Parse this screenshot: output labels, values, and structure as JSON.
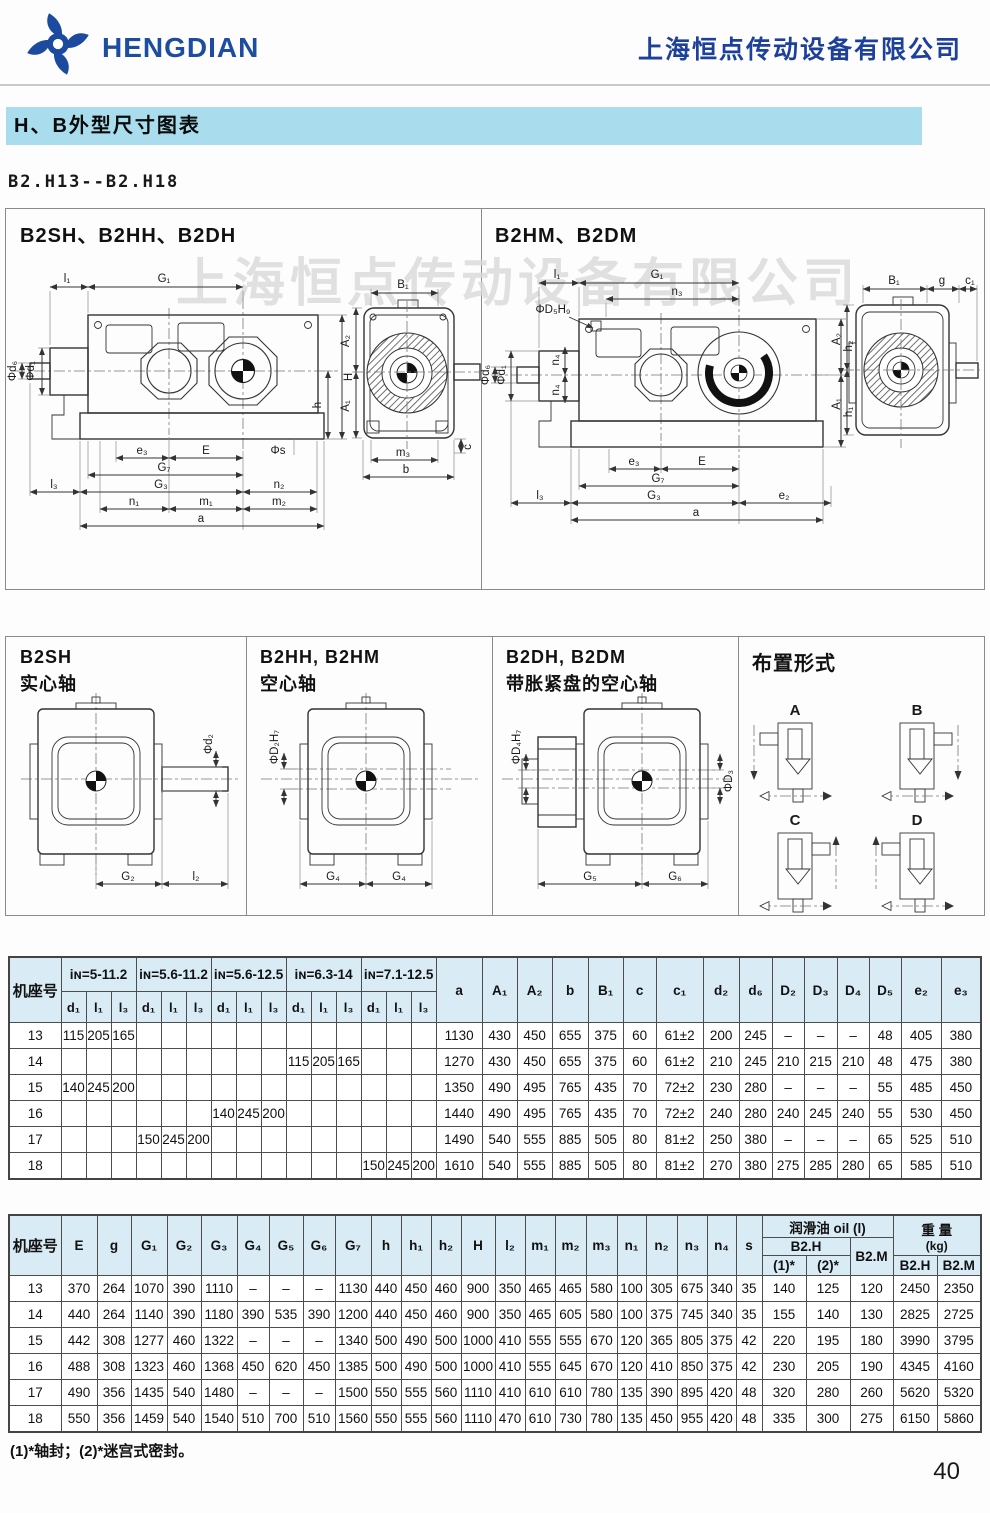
{
  "header": {
    "logo_text": "HENGDIAN",
    "company": "上海恒点传动设备有限公司"
  },
  "section": {
    "title": "H、B外型尺寸图表",
    "model_range": "B2.H13--B2.H18"
  },
  "watermark": "上海恒点传动设备有限公司",
  "colors": {
    "accent_blue": "#1d4da0",
    "banner_bg": "#a9ddee",
    "table_header_bg": "#d9ecf5"
  },
  "diagrams": {
    "panel1": {
      "title": "B2SH、B2HH、B2DH",
      "labels": {
        "l1": "l₁",
        "G1": "G₁",
        "d1": "Φd₁",
        "d6": "Φd₆",
        "H": "H",
        "h": "h",
        "c": "c",
        "e3": "e₃",
        "E": "E",
        "s": "Φs",
        "G7": "G₇",
        "G3": "G₃",
        "n2": "n₂",
        "l3": "l₃",
        "n1": "n₁",
        "m1": "m₁",
        "m2": "m₂",
        "a": "a",
        "B1": "B₁",
        "A2": "A₂",
        "A1": "A₁",
        "m3": "m₃",
        "b": "b"
      }
    },
    "panel2": {
      "title": "B2HM、B2DM",
      "labels": {
        "l1": "l₁",
        "G1": "G₁",
        "n3": "n₃",
        "D5H9": "ΦD₅H₉",
        "d1": "Φd₁",
        "d6": "Φd₆",
        "n4a": "n₄",
        "n4b": "n₄",
        "h2": "h₂",
        "h1": "h₁",
        "e3": "e₃",
        "E": "E",
        "G7": "G₇",
        "G3": "G₃",
        "e2": "e₂",
        "a": "a",
        "l3": "l₃",
        "B1": "B₁",
        "g": "g",
        "c1": "c₁",
        "A2": "A₂",
        "A1": "A₁"
      }
    },
    "panel3": {
      "title": "B2SH",
      "subtitle": "实心轴",
      "labels": {
        "d2": "Φd₂",
        "G2": "G₂",
        "l2": "l₂"
      }
    },
    "panel4": {
      "title": "B2HH, B2HM",
      "subtitle": "空心轴",
      "labels": {
        "D2H7": "ΦD₂H₇",
        "G4a": "G₄",
        "G4b": "G₄"
      }
    },
    "panel5": {
      "title": "B2DH, B2DM",
      "subtitle": "带胀紧盘的空心轴",
      "labels": {
        "D4H7": "ΦD₄H₇",
        "D3": "ΦD₃",
        "G5": "G₅",
        "G6": "G₆"
      }
    },
    "panel6": {
      "title": "布置形式",
      "variants": [
        "A",
        "B",
        "C",
        "D"
      ]
    }
  },
  "table1": {
    "row_header": "机座号",
    "groups": [
      "iɴ=5-11.2",
      "iɴ=5.6-11.2",
      "iɴ=5.6-12.5",
      "iɴ=6.3-14",
      "iɴ=7.1-12.5"
    ],
    "sub_headers": [
      "d₁",
      "l₁",
      "l₃"
    ],
    "tail_headers": [
      "a",
      "A₁",
      "A₂",
      "b",
      "B₁",
      "c",
      "c₁",
      "d₂",
      "d₆",
      "D₂",
      "D₃",
      "D₄",
      "D₅",
      "e₂",
      "e₃"
    ],
    "rows": [
      {
        "id": "13",
        "cells": [
          "115",
          "205",
          "165",
          "",
          "",
          "",
          "",
          "",
          "",
          "",
          "",
          "",
          "",
          "",
          ""
        ],
        "tail": [
          "1130",
          "430",
          "450",
          "655",
          "375",
          "60",
          "61±2",
          "200",
          "245",
          "–",
          "–",
          "–",
          "48",
          "405",
          "380"
        ]
      },
      {
        "id": "14",
        "cells": [
          "",
          "",
          "",
          "",
          "",
          "",
          "",
          "",
          "",
          "115",
          "205",
          "165",
          "",
          "",
          ""
        ],
        "tail": [
          "1270",
          "430",
          "450",
          "655",
          "375",
          "60",
          "61±2",
          "210",
          "245",
          "210",
          "215",
          "210",
          "48",
          "475",
          "380"
        ]
      },
      {
        "id": "15",
        "cells": [
          "140",
          "245",
          "200",
          "",
          "",
          "",
          "",
          "",
          "",
          "",
          "",
          "",
          "",
          "",
          ""
        ],
        "tail": [
          "1350",
          "490",
          "495",
          "765",
          "435",
          "70",
          "72±2",
          "230",
          "280",
          "–",
          "–",
          "–",
          "55",
          "485",
          "450"
        ]
      },
      {
        "id": "16",
        "cells": [
          "",
          "",
          "",
          "",
          "",
          "",
          "140",
          "245",
          "200",
          "",
          "",
          "",
          "",
          "",
          ""
        ],
        "tail": [
          "1440",
          "490",
          "495",
          "765",
          "435",
          "70",
          "72±2",
          "240",
          "280",
          "240",
          "245",
          "240",
          "55",
          "530",
          "450"
        ]
      },
      {
        "id": "17",
        "cells": [
          "",
          "",
          "",
          "150",
          "245",
          "200",
          "",
          "",
          "",
          "",
          "",
          "",
          "",
          "",
          ""
        ],
        "tail": [
          "1490",
          "540",
          "555",
          "885",
          "505",
          "80",
          "81±2",
          "250",
          "380",
          "–",
          "–",
          "–",
          "65",
          "525",
          "510"
        ]
      },
      {
        "id": "18",
        "cells": [
          "",
          "",
          "",
          "",
          "",
          "",
          "",
          "",
          "",
          "",
          "",
          "",
          "150",
          "245",
          "200"
        ],
        "tail": [
          "1610",
          "540",
          "555",
          "885",
          "505",
          "80",
          "81±2",
          "270",
          "380",
          "275",
          "285",
          "280",
          "65",
          "585",
          "510"
        ]
      }
    ]
  },
  "table2": {
    "row_header": "机座号",
    "headers": [
      "E",
      "g",
      "G₁",
      "G₂",
      "G₃",
      "G₄",
      "G₅",
      "G₆",
      "G₇",
      "h",
      "h₁",
      "h₂",
      "H",
      "l₂",
      "m₁",
      "m₂",
      "m₃",
      "n₁",
      "n₂",
      "n₃",
      "n₄",
      "s"
    ],
    "oil": {
      "title": "润滑油 oil (l)",
      "b2h": "B2.H",
      "subs": [
        "(1)*",
        "(2)*"
      ],
      "b2m": "B2.M"
    },
    "weight": {
      "title": "重 量",
      "unit": "(kg)",
      "subs": [
        "B2.H",
        "B2.M"
      ]
    },
    "rows": [
      {
        "id": "13",
        "values": [
          "370",
          "264",
          "1070",
          "390",
          "1110",
          "–",
          "–",
          "–",
          "1130",
          "440",
          "450",
          "460",
          "900",
          "350",
          "465",
          "465",
          "580",
          "100",
          "305",
          "675",
          "340",
          "35"
        ],
        "oil": [
          "140",
          "125",
          "120"
        ],
        "weight": [
          "2450",
          "2350"
        ]
      },
      {
        "id": "14",
        "values": [
          "440",
          "264",
          "1140",
          "390",
          "1180",
          "390",
          "535",
          "390",
          "1200",
          "440",
          "450",
          "460",
          "900",
          "350",
          "465",
          "605",
          "580",
          "100",
          "375",
          "745",
          "340",
          "35"
        ],
        "oil": [
          "155",
          "140",
          "130"
        ],
        "weight": [
          "2825",
          "2725"
        ]
      },
      {
        "id": "15",
        "values": [
          "442",
          "308",
          "1277",
          "460",
          "1322",
          "–",
          "–",
          "–",
          "1340",
          "500",
          "490",
          "500",
          "1000",
          "410",
          "555",
          "555",
          "670",
          "120",
          "365",
          "805",
          "375",
          "42"
        ],
        "oil": [
          "220",
          "195",
          "180"
        ],
        "weight": [
          "3990",
          "3795"
        ]
      },
      {
        "id": "16",
        "values": [
          "488",
          "308",
          "1323",
          "460",
          "1368",
          "450",
          "620",
          "450",
          "1385",
          "500",
          "490",
          "500",
          "1000",
          "410",
          "555",
          "645",
          "670",
          "120",
          "410",
          "850",
          "375",
          "42"
        ],
        "oil": [
          "230",
          "205",
          "190"
        ],
        "weight": [
          "4345",
          "4160"
        ]
      },
      {
        "id": "17",
        "values": [
          "490",
          "356",
          "1435",
          "540",
          "1480",
          "–",
          "–",
          "–",
          "1500",
          "550",
          "555",
          "560",
          "1110",
          "410",
          "610",
          "610",
          "780",
          "135",
          "390",
          "895",
          "420",
          "48"
        ],
        "oil": [
          "320",
          "280",
          "260"
        ],
        "weight": [
          "5620",
          "5320"
        ]
      },
      {
        "id": "18",
        "values": [
          "550",
          "356",
          "1459",
          "540",
          "1540",
          "510",
          "700",
          "510",
          "1560",
          "550",
          "555",
          "560",
          "1110",
          "470",
          "610",
          "730",
          "780",
          "135",
          "450",
          "955",
          "420",
          "48"
        ],
        "oil": [
          "335",
          "300",
          "275"
        ],
        "weight": [
          "6150",
          "5860"
        ]
      }
    ]
  },
  "footer": {
    "note": "(1)*轴封；(2)*迷宫式密封。",
    "page_number": "40"
  }
}
